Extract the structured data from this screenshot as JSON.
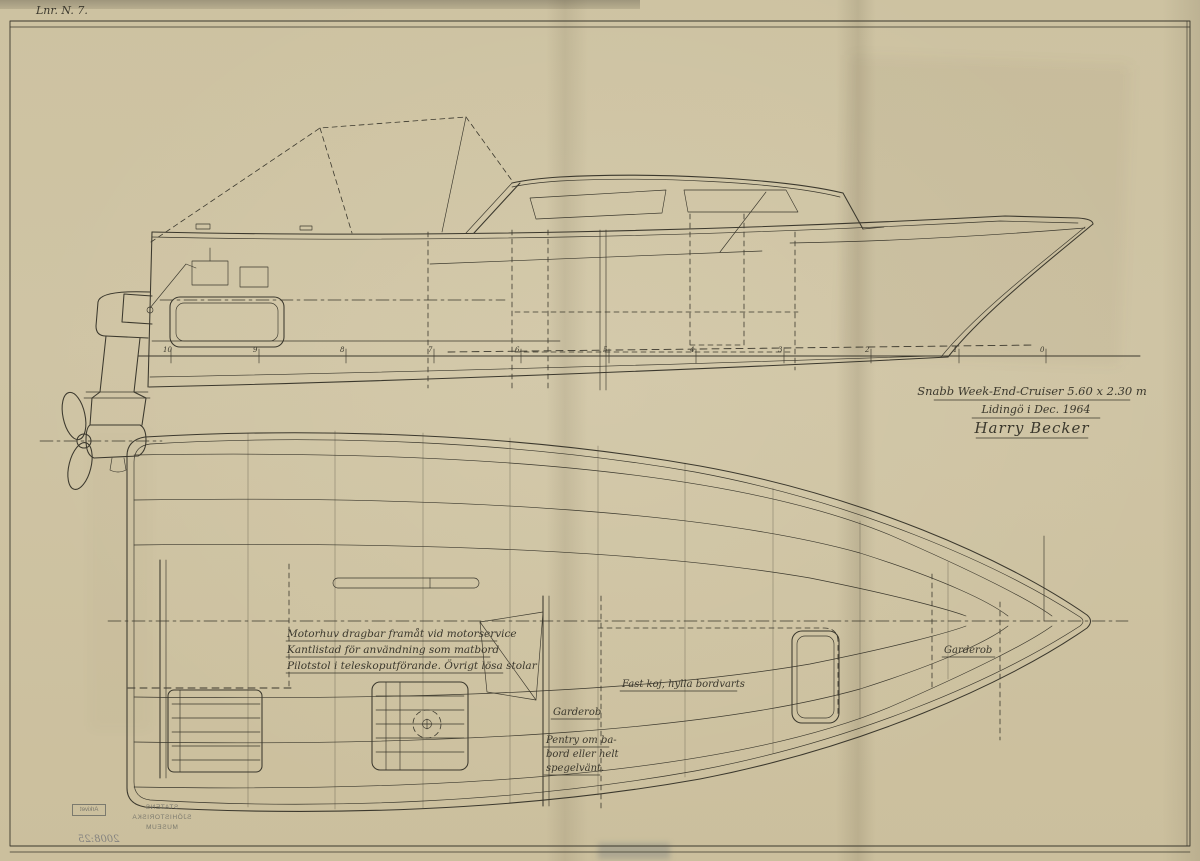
{
  "colors": {
    "paper": "#cfc4a3",
    "ink": "#3b382d",
    "stamp": "#6e6e66"
  },
  "corner_note": "Lnr. N. 7.",
  "title_block": {
    "line1": "Snabb Week-End-Cruiser  5.60 x 2.30 m",
    "line2": "Lidingö i Dec. 1964",
    "signature": "Harry Becker"
  },
  "side_view": {
    "stations": [
      "10",
      "9",
      "8",
      "7",
      "6",
      "5",
      "4",
      "3",
      "2",
      "1",
      "0"
    ]
  },
  "plan_view": {
    "notes": [
      "Motorhuv dragbar framåt vid motorservice",
      "Kantlistad för användning som matbord",
      "Pilotstol i teleskoputförande. Övrigt lösa stolar"
    ],
    "labels": {
      "fast_koj": "Fast koj, hylla bordvarts",
      "garderob_mid": "Garderob",
      "pentry": [
        "Pentry om ba-",
        "bord eller helt",
        "spegelvänt."
      ],
      "garderob_fwd": "Garderob"
    }
  },
  "stamp": {
    "org": [
      "STATENS",
      "SJÖHISTORISKA",
      "MUSEUM"
    ],
    "dept": "Arkivet",
    "number": "2008:25",
    "mirrored": true
  }
}
